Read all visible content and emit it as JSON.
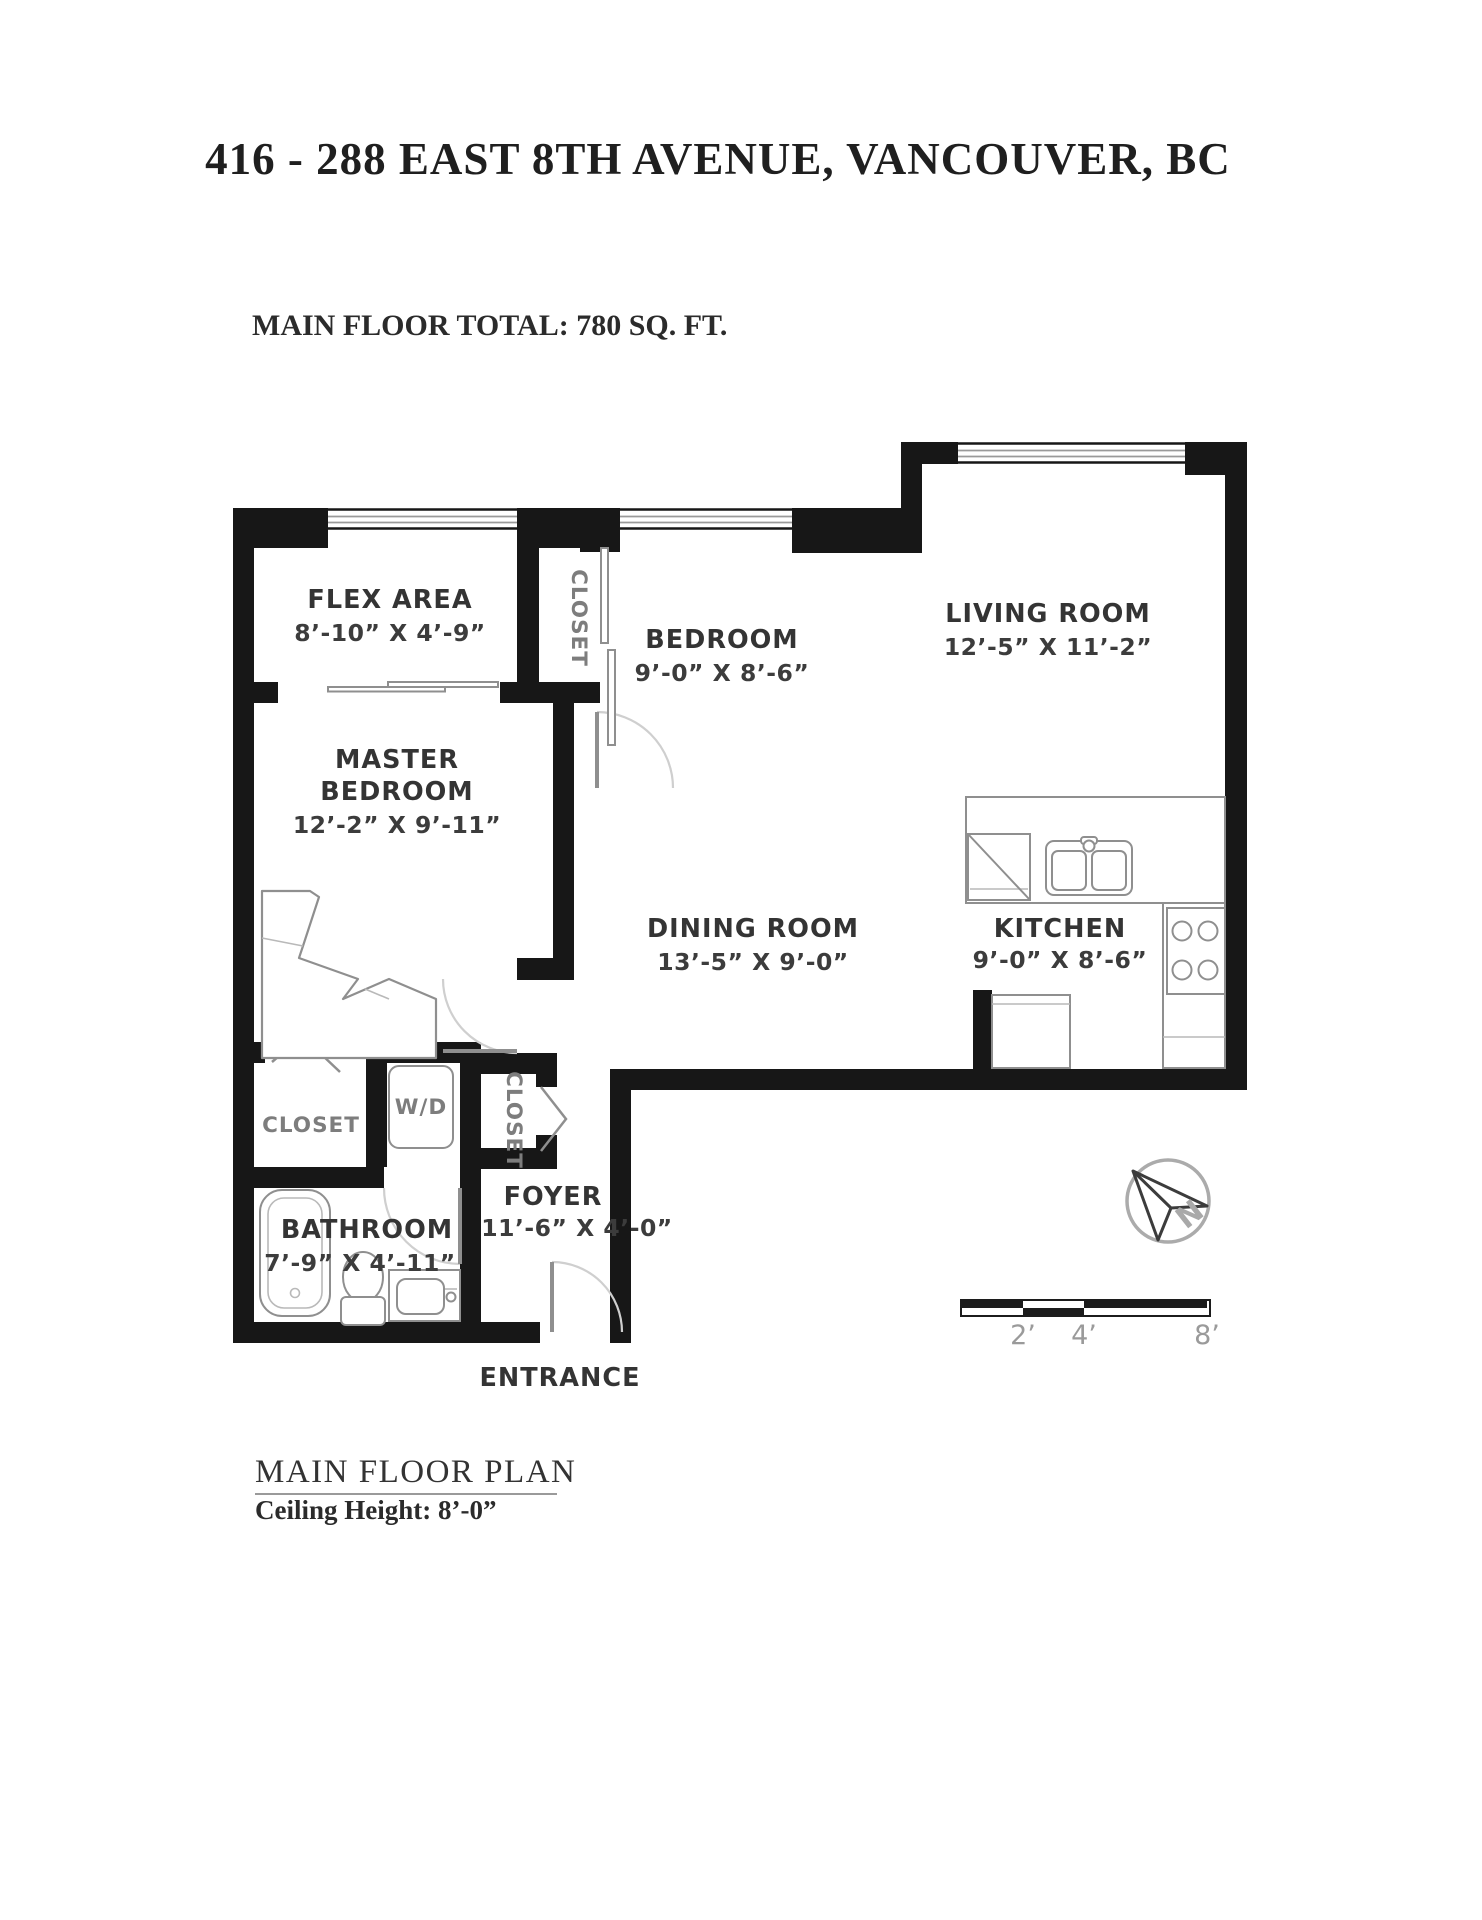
{
  "header": {
    "title": "416 - 288 EAST 8TH AVENUE, VANCOUVER, BC",
    "subtitle": "MAIN FLOOR TOTAL: 780 SQ. FT."
  },
  "rooms": {
    "flex": {
      "name": "FLEX AREA",
      "dims": "8’-10” X 4’-9”"
    },
    "bedroom": {
      "name": "BEDROOM",
      "dims": "9’-0” X 8’-6”"
    },
    "living": {
      "name": "LIVING ROOM",
      "dims": "12’-5” X 11’-2”"
    },
    "master": {
      "name1": "MASTER",
      "name2": "BEDROOM",
      "dims": "12’-2” X 9’-11”"
    },
    "dining": {
      "name": "DINING ROOM",
      "dims": "13’-5” X 9’-0”"
    },
    "kitchen": {
      "name": "KITCHEN",
      "dims": "9’-0” X 8’-6”"
    },
    "bathroom": {
      "name": "BATHROOM",
      "dims": "7’-9” X 4’-11”"
    },
    "foyer": {
      "name": "FOYER",
      "dims": "11’-6” X 4’-0”"
    }
  },
  "labels": {
    "closet_top": "CLOSET",
    "closet_master": "CLOSET",
    "closet_foyer": "CLOSET",
    "washer_dryer": "W/D",
    "entrance": "ENTRANCE"
  },
  "compass": {
    "north": "N"
  },
  "scale_bar": {
    "ticks": [
      "2’",
      "4’",
      "8’"
    ]
  },
  "footer": {
    "plan_title": "MAIN FLOOR PLAN",
    "ceiling": "Ceiling Height: 8’-0”"
  },
  "colors": {
    "background": "#ffffff",
    "wall": "#171717",
    "fixture_stroke": "#8f8f8f",
    "door_arc": "#cfcfcf",
    "room_label": "#343434",
    "muted_label": "#7d7d7d",
    "scale_label": "#9a9a9a"
  }
}
